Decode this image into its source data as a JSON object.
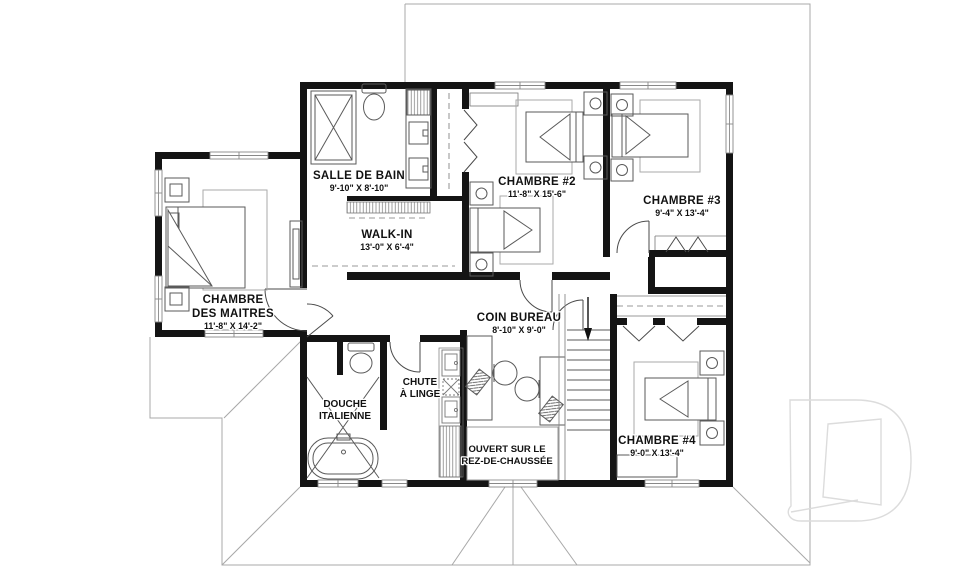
{
  "plan": {
    "title_hint": "second floor plan",
    "rooms": {
      "salle_de_bain": {
        "name": "SALLE DE BAIN",
        "dims": "9'-10\" X 8'-10\""
      },
      "walk_in": {
        "name": "WALK-IN",
        "dims": "13'-0\" X 6'-4\""
      },
      "chambre_2": {
        "name": "CHAMBRE #2",
        "dims": "11'-8\" X 15'-6\""
      },
      "chambre_3": {
        "name": "CHAMBRE #3",
        "dims": "9'-4\" X 13'-4\""
      },
      "chambre_4": {
        "name": "CHAMBRE #4",
        "dims": "9'-0\" X 13'-4\""
      },
      "chambre_des_maitres": {
        "name_line1": "CHAMBRE",
        "name_line2": "DES MAITRES",
        "dims": "11'-8\" X 14'-2\""
      },
      "coin_bureau": {
        "name": "COIN BUREAU",
        "dims": "8'-10\" X 9'-0\""
      },
      "douche_italienne": {
        "name_line1": "DOUCHE",
        "name_line2": "ITALIENNE"
      },
      "chute_a_linge": {
        "name_line1": "CHUTE",
        "name_line2": "À LINGE"
      },
      "ouvert_sur_le_rez_de_chaussee": {
        "name_line1": "OUVERT SUR LE",
        "name_line2": "REZ-DE-CHAUSSÉE"
      }
    },
    "stairs": {
      "direction": "down"
    },
    "watermark_letter": "D",
    "colors": {
      "wall": "#141414",
      "furniture": "#5a5a5a",
      "roof_line": "#a8a8a8",
      "text": "#111111",
      "watermark": "#dcdcdc",
      "background": "#ffffff"
    }
  }
}
